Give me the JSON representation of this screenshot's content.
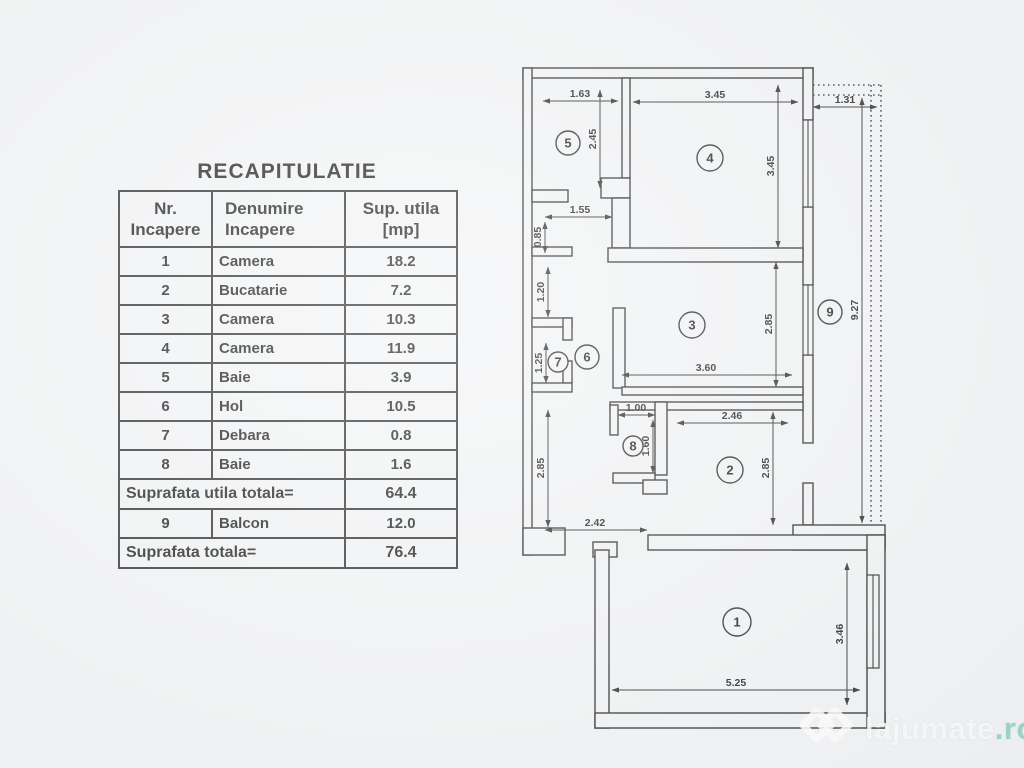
{
  "colors": {
    "paper": "#f3f4f5",
    "ink": "#2b2b2b",
    "watermark_white": "#ffffff",
    "watermark_ro": "#8cd2be"
  },
  "recap": {
    "title": "RECAPITULATIE",
    "headers": {
      "col1": [
        "Nr.",
        "Incapere"
      ],
      "col2": [
        "Denumire",
        "Incapere"
      ],
      "col3": [
        "Sup. utila",
        "[mp]"
      ]
    },
    "rows": [
      {
        "nr": "1",
        "name": "Camera",
        "area": "18.2"
      },
      {
        "nr": "2",
        "name": "Bucatarie",
        "area": "7.2"
      },
      {
        "nr": "3",
        "name": "Camera",
        "area": "10.3"
      },
      {
        "nr": "4",
        "name": "Camera",
        "area": "11.9"
      },
      {
        "nr": "5",
        "name": "Baie",
        "area": "3.9"
      },
      {
        "nr": "6",
        "name": "Hol",
        "area": "10.5"
      },
      {
        "nr": "7",
        "name": "Debara",
        "area": "0.8"
      },
      {
        "nr": "8",
        "name": "Baie",
        "area": "1.6"
      }
    ],
    "subtotal": {
      "label": "Suprafata utila totala=",
      "value": "64.4"
    },
    "balcony_row": {
      "nr": "9",
      "name": "Balcon",
      "area": "12.0"
    },
    "total": {
      "label": "Suprafata totala=",
      "value": "76.4"
    }
  },
  "plan": {
    "rooms": {
      "r1": "1",
      "r2": "2",
      "r3": "3",
      "r4": "4",
      "r5": "5",
      "r6": "6",
      "r7": "7",
      "r8": "8",
      "r9": "9"
    },
    "dims": {
      "room5_w": "1.63",
      "room5_h": "2.45",
      "room4_w": "3.45",
      "room4_h": "3.45",
      "balcony_w": "1.31",
      "pass_155": "1.55",
      "seg_085": "0.85",
      "seg_120": "1.20",
      "seg_125": "1.25",
      "hall_h": "2.85",
      "room3_w": "3.60",
      "room3_h": "2.85",
      "room2_w": "2.46",
      "room2_h": "2.85",
      "room8_w": "1.00",
      "room8_h": "1.60",
      "hall_w": "2.42",
      "balcony_len": "9.27",
      "room1_h": "3.46",
      "room1_w": "5.25"
    }
  },
  "watermark": {
    "name": "lajumate",
    "tld": ".ro"
  }
}
